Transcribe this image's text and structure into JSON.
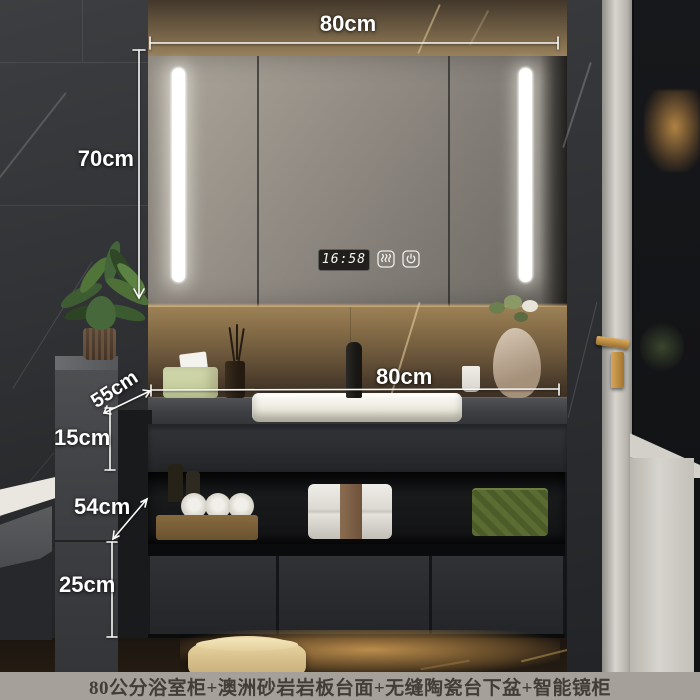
{
  "product": {
    "type": "bathroom-vanity-photo",
    "caption": "80公分浴室柜+澳洲砂岩岩板台面+无缝陶瓷台下盆+智能镜柜"
  },
  "dimensions": {
    "mirror_width": "80cm",
    "mirror_height": "70cm",
    "counter_width": "80cm",
    "counter_depth": "55cm",
    "counter_front_height": "15cm",
    "open_shelf_height": "54cm",
    "drawer_section_height": "25cm"
  },
  "mirror": {
    "clock_time": "16:58",
    "icons": [
      "defog-icon",
      "power-icon"
    ]
  },
  "colors": {
    "annotation_text": "#ffffff",
    "caption_background": "#a6a09b",
    "caption_text": "#423d37",
    "led_strip": "#ffffff",
    "warm_light": "#c9a05a",
    "cabinet": "#2a2c2f"
  }
}
